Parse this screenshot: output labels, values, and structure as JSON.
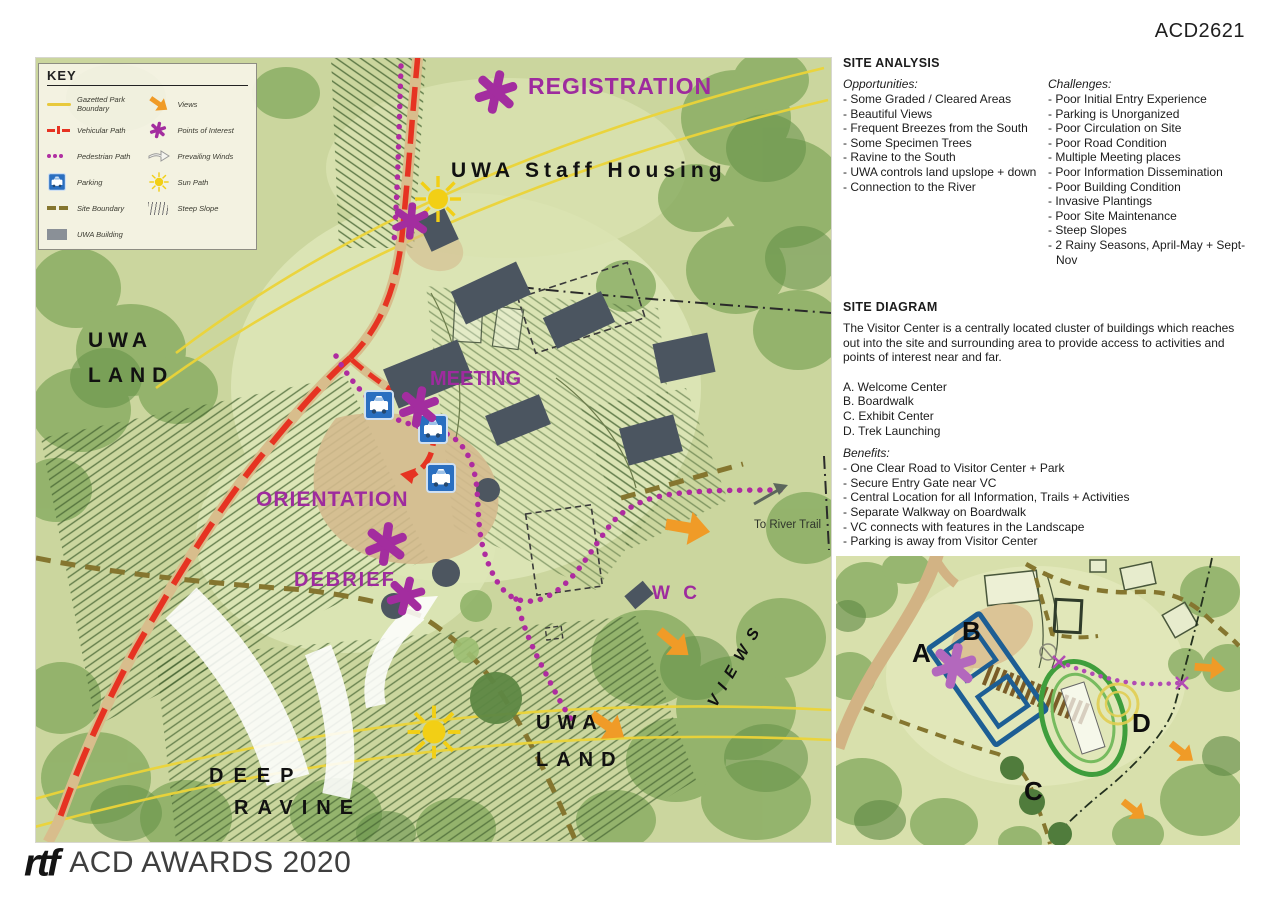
{
  "page": {
    "code": "ACD2621"
  },
  "footer": {
    "logo": "rtf",
    "text": "ACD AWARDS 2020"
  },
  "key": {
    "title": "KEY",
    "left": [
      {
        "icon": "park-boundary-line",
        "label": "Gazetted Park Boundary"
      },
      {
        "icon": "vehicular-path",
        "label": "Vehicular Path"
      },
      {
        "icon": "pedestrian-path",
        "label": "Pedestrian Path"
      },
      {
        "icon": "parking",
        "label": "Parking"
      },
      {
        "icon": "site-boundary",
        "label": "Site Boundary"
      },
      {
        "icon": "uwa-building",
        "label": "UWA Building"
      }
    ],
    "right": [
      {
        "icon": "views-arrow",
        "label": "Views"
      },
      {
        "icon": "points-of-interest-asterisk",
        "label": "Points of Interest"
      },
      {
        "icon": "prevailing-winds-arrow",
        "label": "Prevailing Winds"
      },
      {
        "icon": "sun",
        "label": "Sun Path"
      },
      {
        "icon": "steep-slope-hatch",
        "label": "Steep Slope"
      }
    ]
  },
  "map_labels": {
    "registration": "REGISTRATION",
    "staff_housing": "UWA Staff Housing",
    "uwa_land_line1": "UWA",
    "uwa_land_line2": "LAND",
    "meeting": "MEETING",
    "orientation": "ORIENTATION",
    "debrief": "DEBRIEF",
    "wc": "W C",
    "to_river_trail": "To River Trail",
    "views": "VIEWS",
    "uwa_land2_line1": "UWA",
    "uwa_land2_line2": "LAND",
    "deep_ravine_line1": "DEEP",
    "deep_ravine_line2": "RAVINE"
  },
  "site_analysis": {
    "title": "SITE ANALYSIS",
    "opportunities_heading": "Opportunities:",
    "opportunities": [
      "- Some Graded / Cleared Areas",
      "- Beautiful Views",
      "- Frequent Breezes from the South",
      "- Some Specimen Trees",
      "- Ravine to the South",
      "- UWA controls land upslope + down",
      "- Connection to the River"
    ],
    "challenges_heading": "Challenges:",
    "challenges": [
      "- Poor Initial Entry Experience",
      "- Parking is Unorganized",
      "- Poor Circulation on Site",
      "- Poor Road Condition",
      "- Multiple Meeting places",
      "- Poor Information Dissemination",
      "- Poor Building Condition",
      "- Invasive Plantings",
      "- Poor Site Maintenance",
      "- Steep Slopes",
      "- 2 Rainy Seasons, April-May + Sept-Nov"
    ]
  },
  "site_diagram": {
    "title": "SITE DIAGRAM",
    "description": "The Visitor Center is a centrally located cluster of buildings which reaches out into the site and surrounding area to provide access to activities and points of interest near and far.",
    "locations": [
      "A. Welcome Center",
      "B. Boardwalk",
      "C. Exhibit Center",
      "D. Trek Launching"
    ],
    "benefits_heading": "Benefits:",
    "benefits": [
      "- One Clear Road to Visitor Center + Park",
      "- Secure Entry Gate near VC",
      "- Central Location for all Information, Trails + Activities",
      "- Separate Walkway on Boardwalk",
      "- VC connects with features in the Landscape",
      "- Parking is away from Visitor Center"
    ]
  },
  "inset": {
    "a": "A",
    "b": "B",
    "c": "C",
    "d": "D"
  },
  "colors": {
    "accent_magenta": "#a32d9f",
    "path_red": "#e63322",
    "sun_yellow": "#f2cf15",
    "views_orange": "#f09b27",
    "boundary_olive": "#85762f",
    "building_gray": "#4b5560",
    "parking_blue": "#2a6fc0",
    "inset_blue": "#1d5e94",
    "inset_green": "#3f9e3c",
    "map_green": "#cbd69e"
  }
}
